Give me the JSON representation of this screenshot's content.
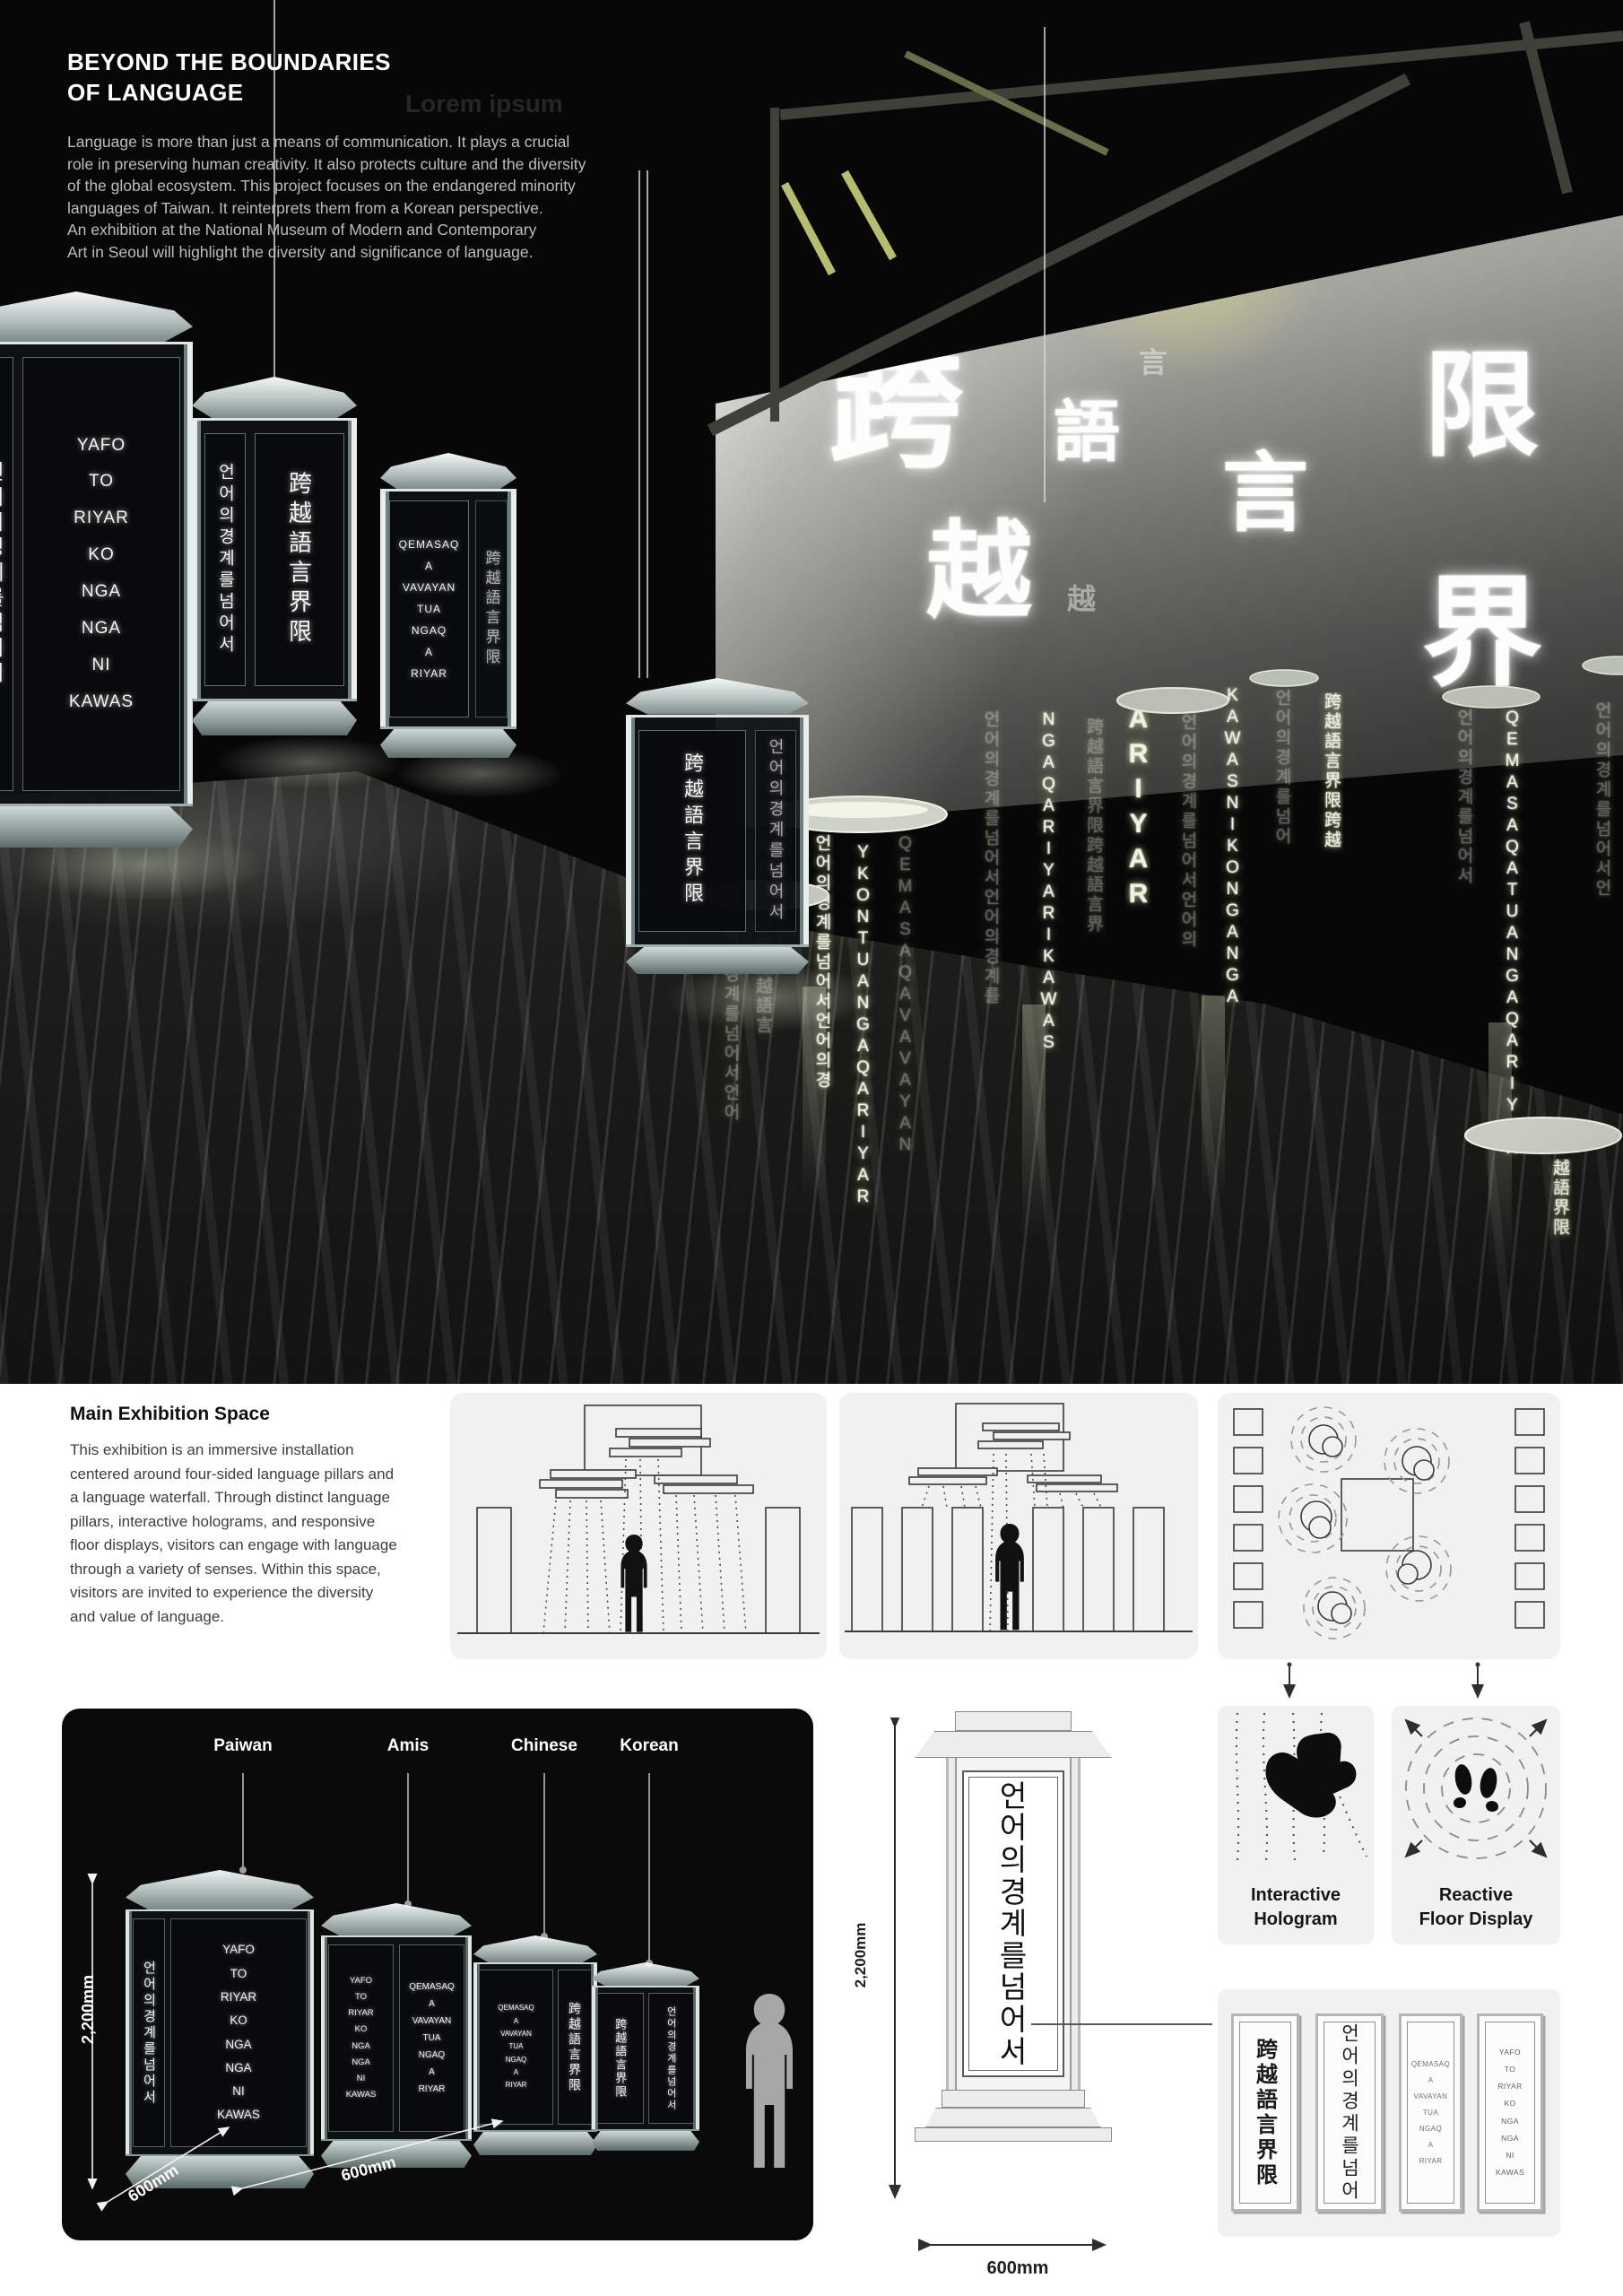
{
  "hero": {
    "title_line1": "BEYOND THE BOUNDARIES",
    "title_line2": "OF LANGUAGE",
    "intro": "Language is more than just a means of communication. It plays a crucial\nrole in preserving human creativity. It also protects culture and the diversity\nof the global ecosystem. This project focuses on the endangered minority\nlanguages of Taiwan. It reinterprets them from a Korean perspective.\nAn exhibition at the National Museum of Modern and Contemporary\nArt in Seoul will highlight the diversity and significance of language.",
    "watermark": "Lorem ipsum",
    "screen_chars": [
      "跨",
      "語",
      "言",
      "越",
      "限",
      "界"
    ],
    "screen_chars_small": [
      "言",
      "越"
    ],
    "waterfalls": [
      "언어의경계를넘어서언어",
      "跨越語言界限跨越語言",
      "언어의경계를넘어서언어의경",
      "YKONTUANGAQARIYAR",
      "QEMASAQAVAVAYAN",
      "언어의경계를넘어서언어의경계를",
      "NGAQARIYARIKAWAS",
      "跨越語言界限跨越語言界",
      "ARIYAR",
      "언어의경계를넘어서언어의",
      "KAWASNIKONGANGA",
      "언어의경계를넘어",
      "跨越語言界限跨越",
      "언어의경계를넘어서",
      "QEMASAQATUANGAQARIYAR",
      "越語界限",
      "언어의경계를넘어서언"
    ]
  },
  "inscriptions": {
    "amis": "YAFO\nTO\nRIYAR\nKO\nNGA\nNGA\nNI\nKAWAS",
    "paiwan": "QEMASAQ\nA\nVAVAYAN\nTUA\nNGAQ\nA\nRIYAR",
    "chinese": "跨越語言界限",
    "korean": "언어의경계를넘어서",
    "korean_short": "언어의경계를넘어"
  },
  "exhibition": {
    "heading": "Main Exhibition Space",
    "body": "This exhibition is an immersive installation\ncentered around four-sided language pillars and\na language waterfall. Through distinct language\npillars, interactive holograms, and responsive\nfloor displays, visitors can engage with language\nthrough a variety of senses. Within this space,\nvisitors are invited to experience the diversity\nand value of language."
  },
  "lineup": {
    "labels": [
      "Paiwan",
      "Amis",
      "Chinese",
      "Korean"
    ],
    "height": "2,200mm",
    "depth": "600mm",
    "width": "600mm"
  },
  "detail": {
    "height": "2,200mm",
    "width": "600mm",
    "chars": [
      "언",
      "어",
      "의",
      "경",
      "계",
      "를",
      "넘",
      "어",
      "서"
    ]
  },
  "features": {
    "hologram_line1": "Interactive",
    "hologram_line2": "Hologram",
    "floor_line1": "Reactive",
    "floor_line2": "Floor Display"
  }
}
